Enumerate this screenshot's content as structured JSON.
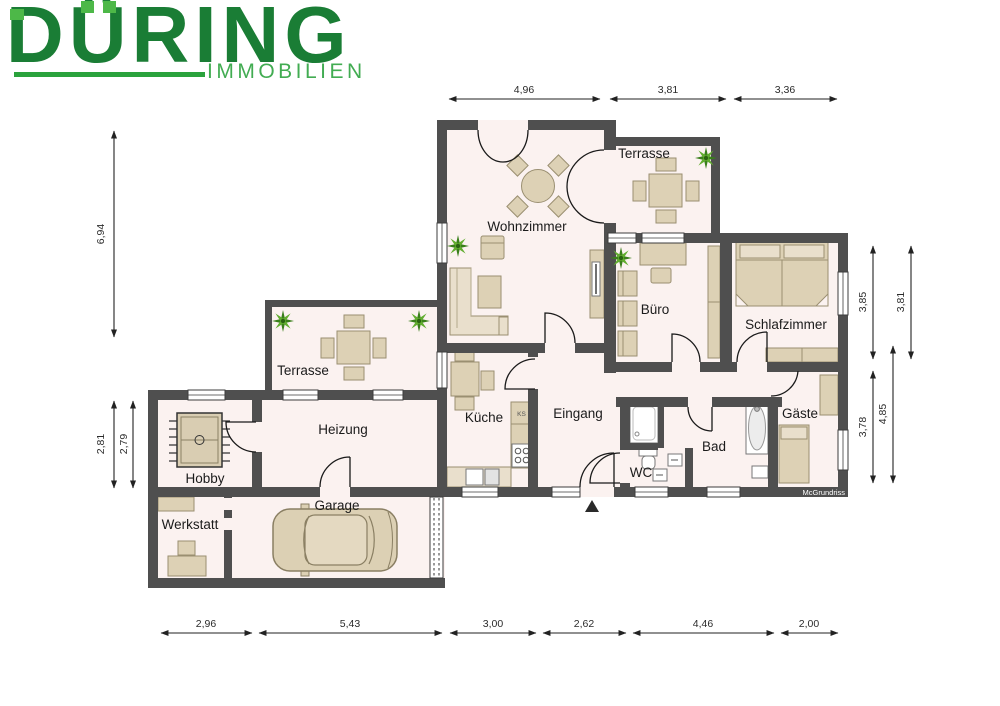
{
  "logo": {
    "brand": "DÜRING",
    "tagline": "IMMOBILIEN",
    "brand_color": "#1a7d35",
    "accent_color": "#4db848",
    "tagline_color": "#42ac52"
  },
  "watermark": "McGrundriss",
  "rooms": {
    "wohnzimmer": "Wohnzimmer",
    "terrasse_top": "Terrasse",
    "buero": "Büro",
    "schlafzimmer": "Schlafzimmer",
    "terrasse_left": "Terrasse",
    "heizung": "Heizung",
    "kueche": "Küche",
    "eingang": "Eingang",
    "hobby": "Hobby",
    "bad": "Bad",
    "wc": "WC",
    "gaeste": "Gäste",
    "werkstatt": "Werkstatt",
    "garage": "Garage",
    "ks": "KS"
  },
  "dimensions": {
    "top": [
      "4,96",
      "3,81",
      "3,36"
    ],
    "left": [
      "6,94",
      "2,81",
      "2,79"
    ],
    "right": [
      "3,85",
      "3,81",
      "3,78",
      "4,85"
    ],
    "bottom": [
      "2,96",
      "5,43",
      "3,00",
      "2,62",
      "4,46",
      "2,00"
    ]
  },
  "colors": {
    "wall": "#4f4f4f",
    "floor": "#fbf2f0",
    "furniture": "#ddd1b5",
    "plant_green": "#397f1a"
  }
}
